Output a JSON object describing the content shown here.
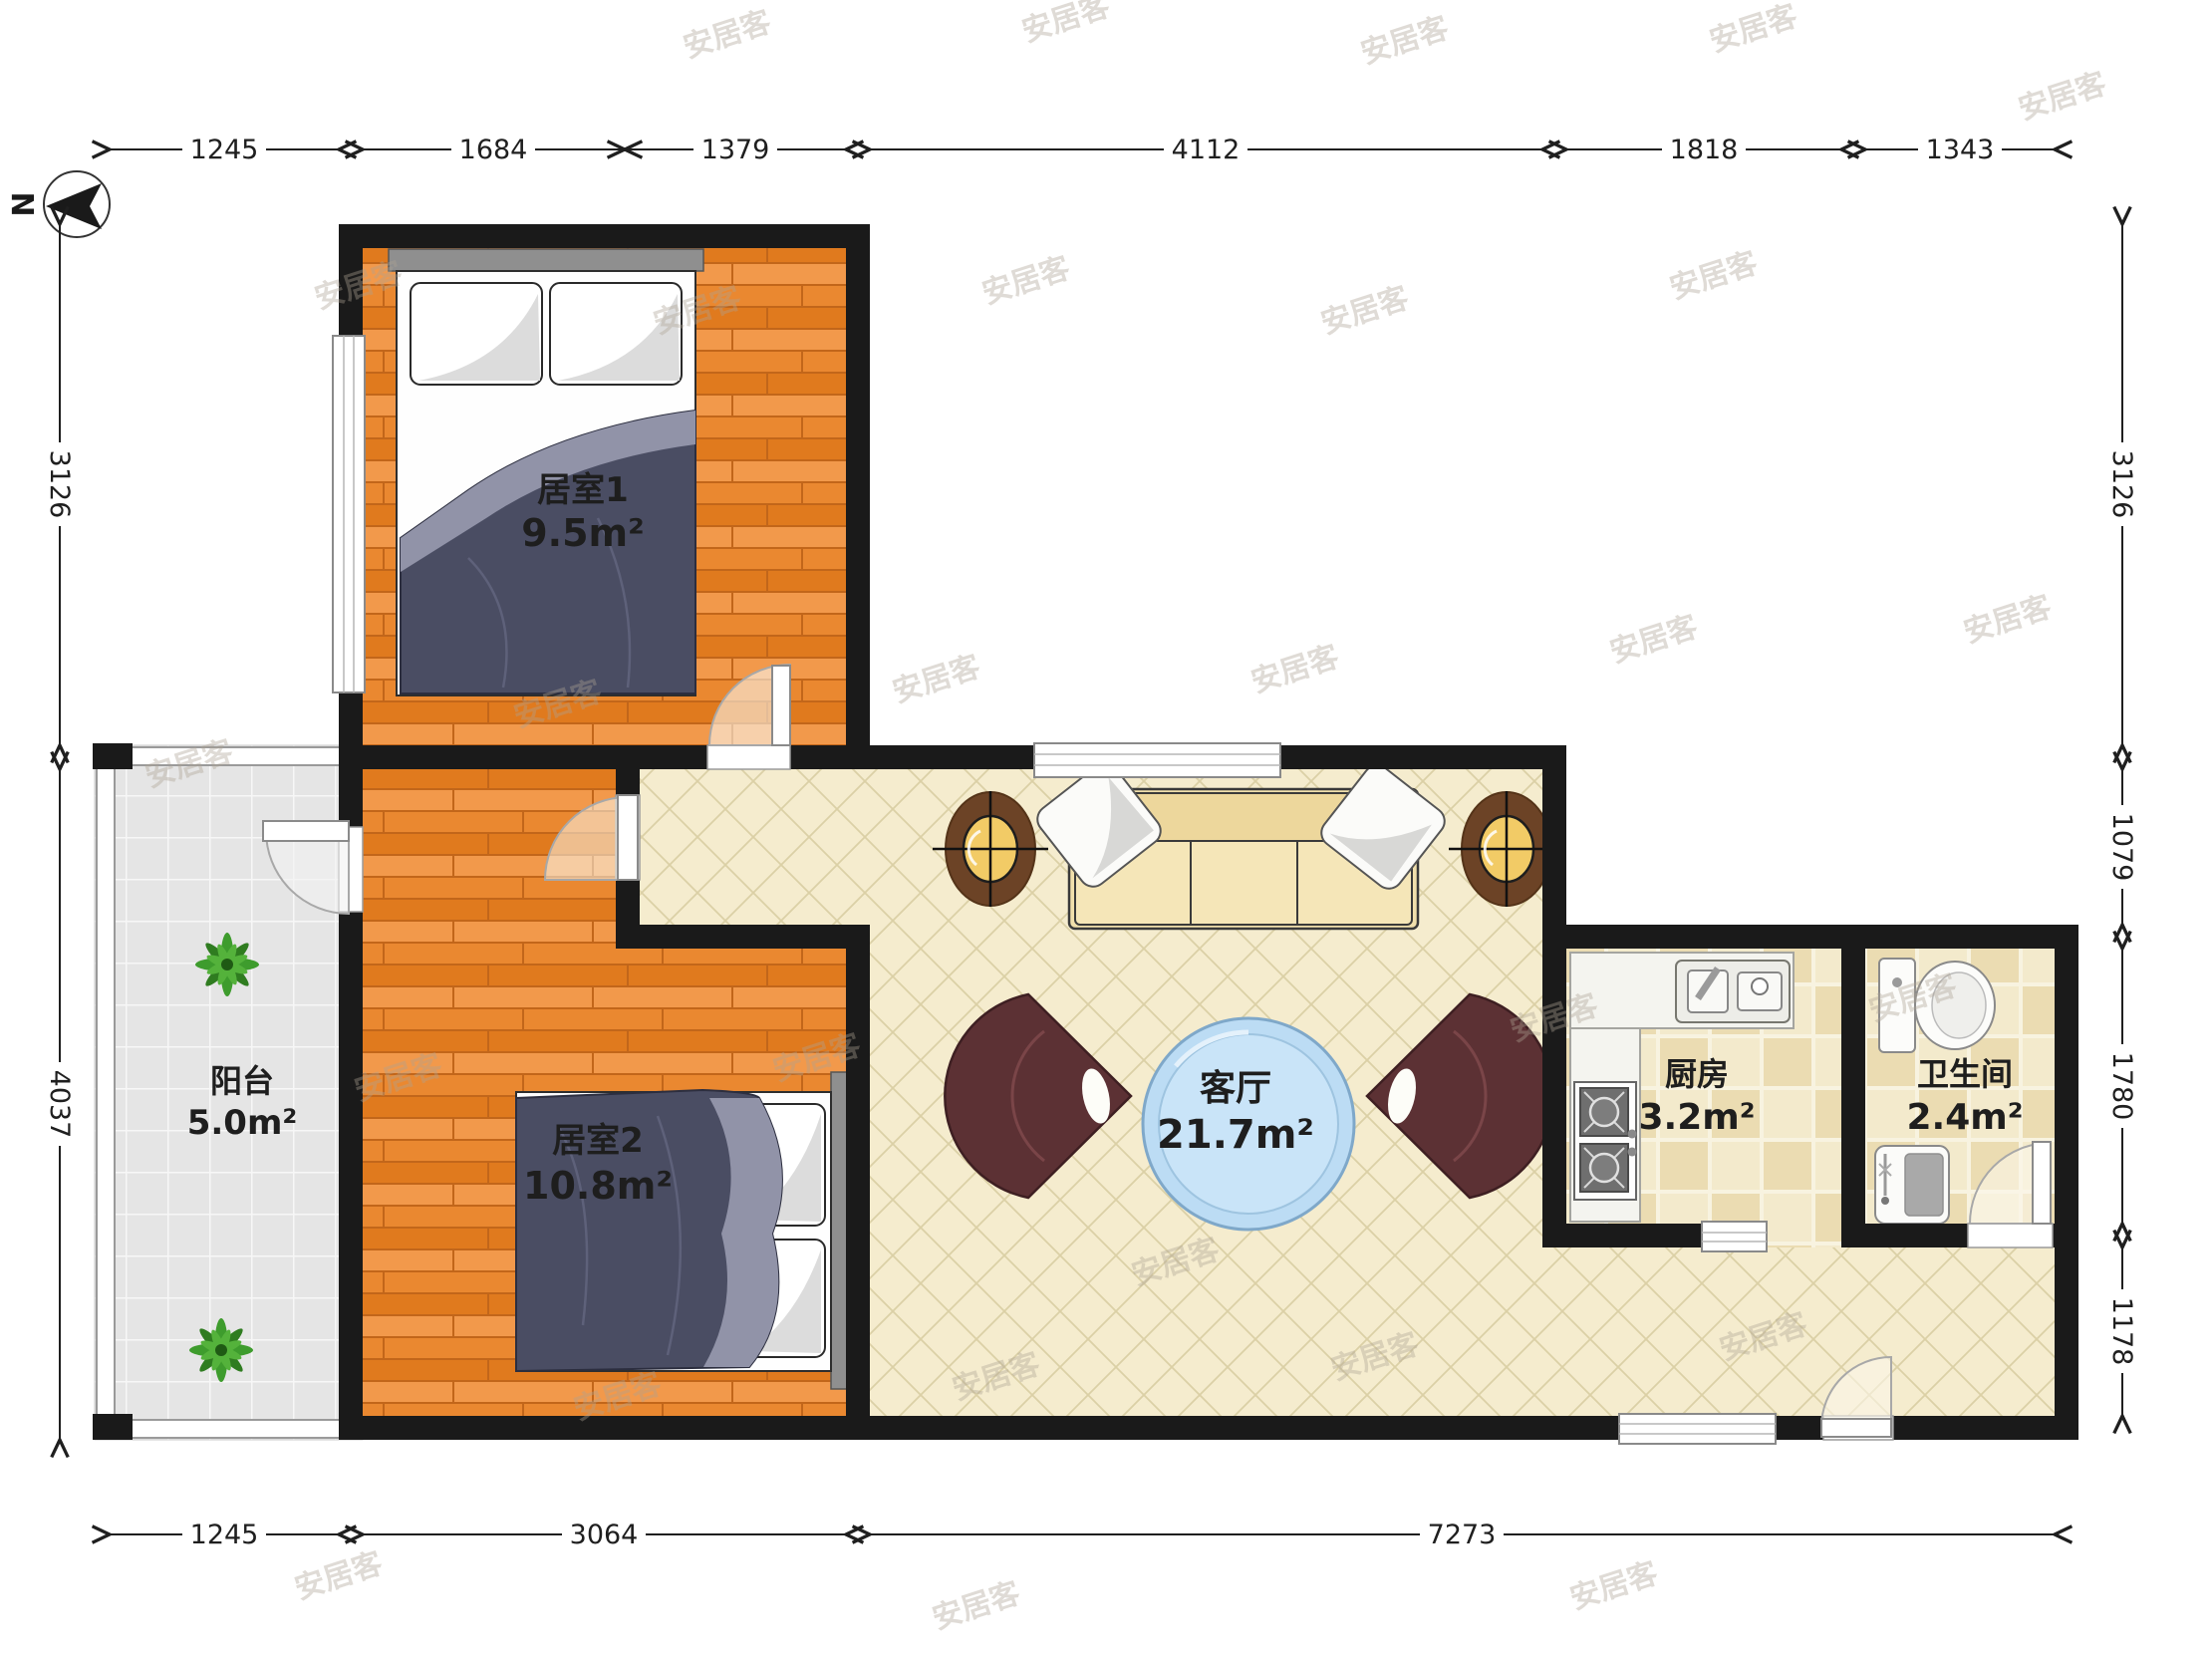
{
  "meta": {
    "north_label": "N",
    "watermark": "安居客"
  },
  "rooms": {
    "bedroom1": {
      "name": "居室1",
      "area": "9.5m²"
    },
    "bedroom2": {
      "name": "居室2",
      "area": "10.8m²"
    },
    "living": {
      "name": "客厅",
      "area": "21.7m²"
    },
    "kitchen": {
      "name": "厨房",
      "area": "3.2m²"
    },
    "bathroom": {
      "name": "卫生间",
      "area": "2.4m²"
    },
    "balcony": {
      "name": "阳台",
      "area": "5.0m²"
    }
  },
  "dimensions": {
    "top": [
      "1245",
      "1684",
      "1379",
      "4112",
      "1818",
      "1343"
    ],
    "bottom": [
      "1245",
      "3064",
      "7273"
    ],
    "left": [
      "3126",
      "4037"
    ],
    "right": [
      "3126",
      "1079",
      "1780",
      "1178"
    ]
  }
}
